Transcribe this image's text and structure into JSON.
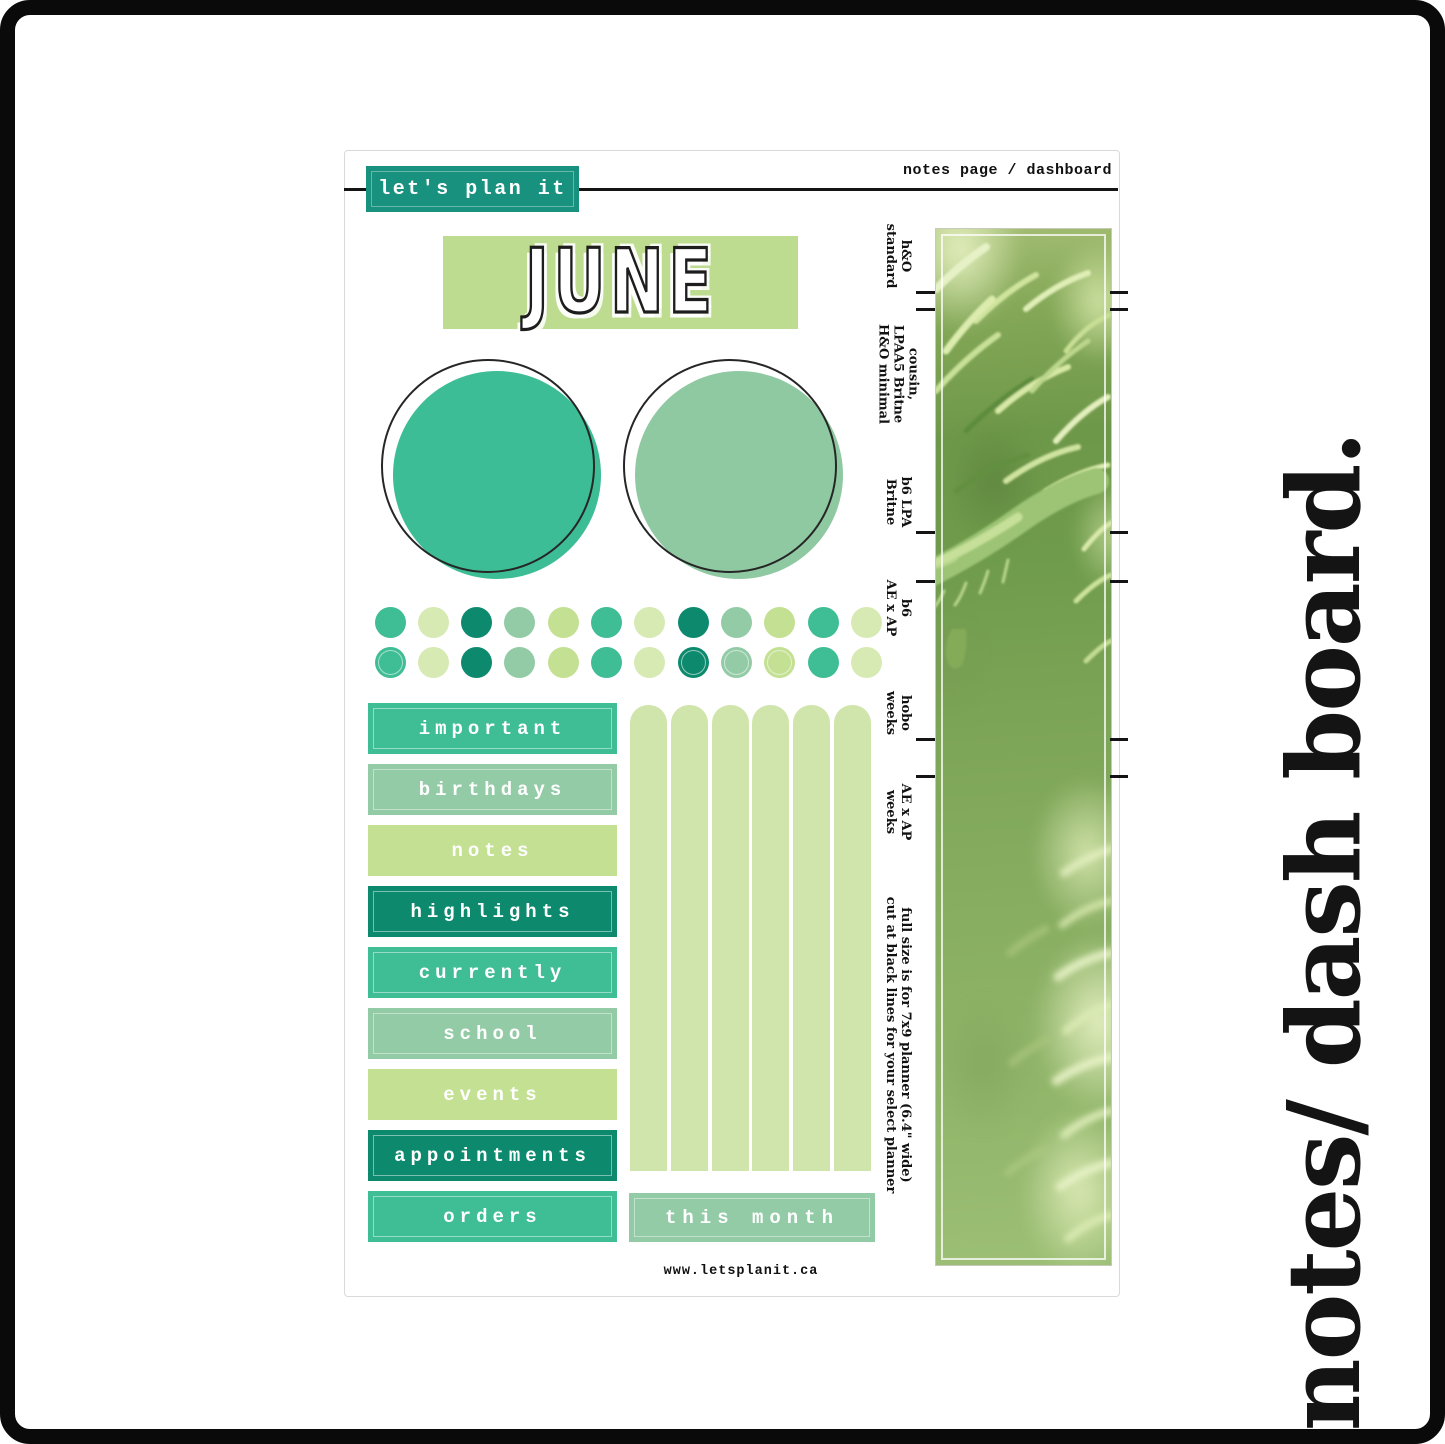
{
  "header": {
    "brand": "let's plan it",
    "page_type": "notes page / dashboard"
  },
  "month_title": "JUNE",
  "website": "www.letsplanit.ca",
  "side_title": "notes/ dash board.",
  "this_month_label": {
    "text": "this month",
    "style": "sage"
  },
  "category_labels": [
    {
      "text": "important",
      "style": "teal",
      "inner": true
    },
    {
      "text": "birthdays",
      "style": "sage",
      "inner": true
    },
    {
      "text": "notes",
      "style": "lime",
      "inner": false
    },
    {
      "text": "highlights",
      "style": "darkteal",
      "inner": true
    },
    {
      "text": "currently",
      "style": "teal",
      "inner": true
    },
    {
      "text": "school",
      "style": "sage",
      "inner": true
    },
    {
      "text": "events",
      "style": "lime",
      "inner": false
    },
    {
      "text": "appointments",
      "style": "darkteal",
      "inner": true
    },
    {
      "text": "orders",
      "style": "teal",
      "inner": true
    }
  ],
  "bars": {
    "count": 6
  },
  "dots": {
    "sequence": [
      "teal",
      "pale",
      "darkteal",
      "sage",
      "lime",
      "teal",
      "pale",
      "darkteal",
      "sage",
      "lime",
      "teal",
      "pale"
    ],
    "row2_ring_indexes": [
      0,
      7,
      8,
      9
    ]
  },
  "strip": {
    "cut_labels": [
      {
        "lines": [
          "h&O",
          "standard"
        ],
        "y": 256
      },
      {
        "lines": [
          "cousin,",
          "LPAA5 Britne",
          "H&O minimal"
        ],
        "y": 374
      },
      {
        "lines": [
          "b6 LPA",
          "Britne"
        ],
        "y": 502
      },
      {
        "lines": [
          "b6",
          "AE x AP"
        ],
        "y": 608
      },
      {
        "lines": [
          "hobo",
          "weeks"
        ],
        "y": 713
      },
      {
        "lines": [
          "AE x AP",
          "weeks"
        ],
        "y": 812
      },
      {
        "lines": [
          "full size is for 7x9 planner (6.4\" wide)",
          "cut at black lines for your select planner"
        ],
        "y": 1045
      }
    ],
    "cut_ticks_y": [
      292,
      309,
      532,
      581,
      739,
      776
    ]
  },
  "colors": {
    "teal": "#3fbd95",
    "sage": "#93cba6",
    "lime": "#c4e093",
    "darkteal": "#0d8a6e",
    "pale": "#d7eab3",
    "bar": "#d0e5ac",
    "june_bg": "#bedc90",
    "brand_bg": "#19917f",
    "circle_teal": "#3dbd95",
    "circle_sage": "#8fc9a2"
  }
}
